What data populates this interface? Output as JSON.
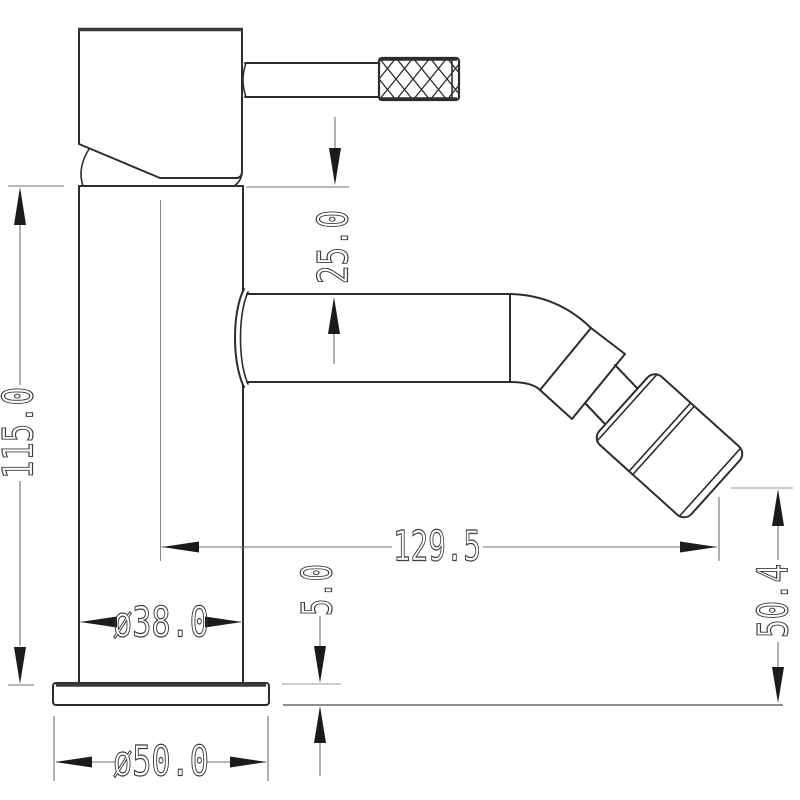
{
  "drawing": {
    "subject": "single-lever-mixer-tap-side-elevation",
    "units_style": "mm-decimal",
    "colors": {
      "background": "#ffffff",
      "outline": "#2d2d2d",
      "dimension_lines": "#6f6f6f",
      "dimension_text": "#3c3c3c",
      "arrowheads": "#1b1b1b"
    },
    "dimensions": {
      "total_height": "115.0",
      "handle_clearance": "25.0",
      "spout_reach": "129.5",
      "outlet_height": "50.4",
      "base_thickness": "5.0",
      "body_diameter": "ø38.0",
      "base_diameter": "ø50.0"
    }
  }
}
